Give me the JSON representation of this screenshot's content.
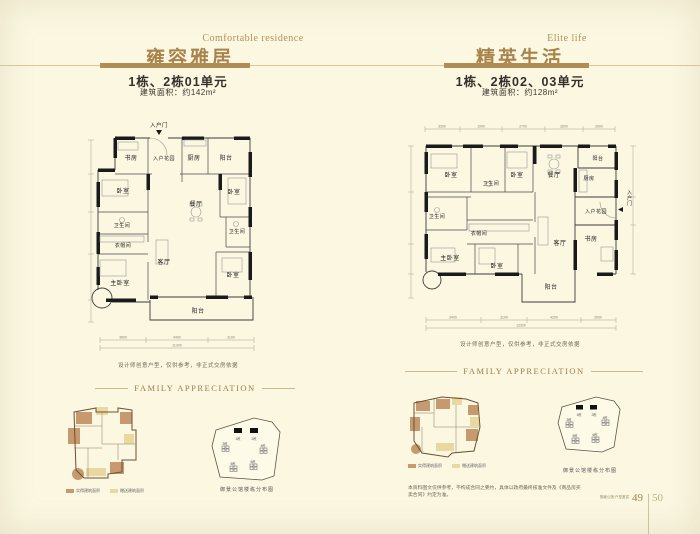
{
  "colors": {
    "bg": "#FBF7E1",
    "accent": "#B18C55",
    "tan": "#C69A6E",
    "cream": "#E9D9A0"
  },
  "header_left": {
    "title_en": "Comfortable residence",
    "title_cn": "雍容雅居",
    "unit": "1栋、2栋01单元",
    "area": "建筑面积：约142m²"
  },
  "header_right": {
    "title_en": "Elite life",
    "title_cn": "精英生活",
    "unit": "1栋、2栋02、03单元",
    "area": "建筑面积：约128m²"
  },
  "plan_left": {
    "entry_door": "入户门",
    "study": "书房",
    "entry_garden": "入户花园",
    "kitchen": "厨房",
    "balcony_top": "阳台",
    "bedroom_left": "卧室",
    "bedroom_right": "卧室",
    "dining": "餐厅",
    "bath_left": "卫生间",
    "bath_right": "卫生间",
    "cloakroom": "衣帽间",
    "living": "客厅",
    "master_bedroom": "主卧室",
    "bedroom_bottom": "卧室",
    "balcony_bottom": "阳台",
    "dims": [
      "3800",
      "4400",
      "3100"
    ],
    "dim_total": "11300",
    "note": "设计师创意户型，仅供参考，非正式交房依据"
  },
  "plan_right": {
    "bedroom_tl": "卧室",
    "bath_top": "卫生间",
    "bedroom_tc": "卧室",
    "dining": "餐厅",
    "balcony_tr": "阳台",
    "kitchen": "厨房",
    "entry_garden": "入户花园",
    "entry_door": "入户门",
    "bath_left": "卫生间",
    "cloakroom": "衣帽间",
    "master_bedroom": "主卧室",
    "bedroom_bc": "卧室",
    "living": "客厅",
    "study": "书房",
    "balcony_bottom": "阳台",
    "dims_top": [
      "3300",
      "1900",
      "2700",
      "3600",
      "2600"
    ],
    "dims_bottom": [
      "3400",
      "3100",
      "4200",
      "2600"
    ],
    "dim_total": "12300",
    "note": "设计师创意户型，仅供参考，非正式交房依据"
  },
  "family": {
    "heading": "FAMILY APPRECIATION",
    "legend": [
      {
        "label": "实得建筑面积"
      },
      {
        "label": "赠送建筑面积"
      }
    ],
    "siteplan_caption": "御景公馆楼栋分布图",
    "buildings": [
      "1栋",
      "2栋",
      "3栋",
      "4栋",
      "5栋",
      "6栋"
    ]
  },
  "footer": {
    "note": "本资料图文仅供参考，不构成合同之要约，具体以政府最终核准文件及《商品房买卖合同》约定为准。",
    "page_caption": "御景公馆·户型鉴赏",
    "page_left": "49",
    "page_right": "50"
  }
}
